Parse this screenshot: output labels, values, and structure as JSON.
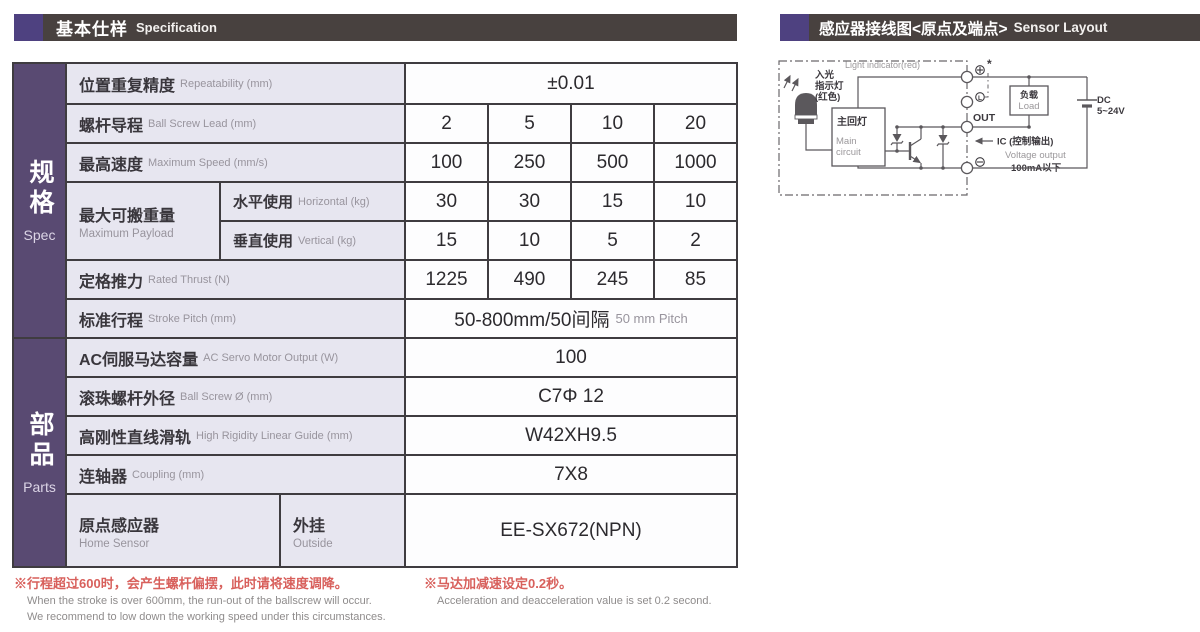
{
  "colors": {
    "header_bar_bg": "#48413f",
    "accent_purple": "#4e4180",
    "sidebar_purple": "#594a72",
    "label_cell_bg": "#e7e6f0",
    "table_border": "#3f3c40",
    "note_red": "#d8605c",
    "secondary_gray": "#98949d"
  },
  "spec": {
    "header": {
      "zh": "基本仕样",
      "en": "Specification"
    },
    "sidebar": {
      "spec_zh": "规格",
      "spec_en": "Spec",
      "parts_zh": "部品",
      "parts_en": "Parts"
    },
    "rows": [
      {
        "zh": "位置重复精度",
        "en": "Repeatability (mm)",
        "value": "±0.01"
      },
      {
        "zh": "螺杆导程",
        "en": "Ball Screw Lead (mm)",
        "v1": "2",
        "v2": "5",
        "v3": "10",
        "v4": "20"
      },
      {
        "zh": "最高速度",
        "en": "Maximum Speed (mm/s)",
        "v1": "100",
        "v2": "250",
        "v3": "500",
        "v4": "1000"
      },
      {
        "zh": "最大可搬重量",
        "en": "Maximum Payload",
        "sub1": {
          "zh": "水平使用",
          "en": "Horizontal (kg)",
          "v1": "30",
          "v2": "30",
          "v3": "15",
          "v4": "10"
        },
        "sub2": {
          "zh": "垂直使用",
          "en": "Vertical (kg)",
          "v1": "15",
          "v2": "10",
          "v3": "5",
          "v4": "2"
        }
      },
      {
        "zh": "定格推力",
        "en": "Rated Thrust (N)",
        "v1": "1225",
        "v2": "490",
        "v3": "245",
        "v4": "85"
      },
      {
        "zh": "标准行程",
        "en": "Stroke Pitch (mm)",
        "value": "50-800mm/50间隔",
        "value_en": "50 mm Pitch"
      },
      {
        "zh": "AC伺服马达容量",
        "en": "AC Servo Motor Output (W)",
        "value": "100"
      },
      {
        "zh": "滚珠螺杆外径",
        "en": "Ball Screw Ø (mm)",
        "value": "C7Φ 12"
      },
      {
        "zh": "高刚性直线滑轨",
        "en": "High Rigidity Linear Guide (mm)",
        "value": "W42XH9.5"
      },
      {
        "zh": "连轴器",
        "en": "Coupling (mm)",
        "value": "7X8"
      },
      {
        "zh": "原点感应器",
        "en": "Home Sensor",
        "sub_zh": "外挂",
        "sub_en": "Outside",
        "value": "EE-SX672(NPN)"
      }
    ],
    "notes": {
      "note1_zh": "※行程超过600时，会产生螺杆偏摆，此时请将速度调降。",
      "note1_en1": "When the stroke is over 600mm, the run-out of the ballscrew will occur.",
      "note1_en2": "We recommend to low down the working speed under this circumstances.",
      "note2_zh": "※马达加减速设定0.2秒。",
      "note2_en": "Acceleration and deacceleration value is set 0.2 second."
    }
  },
  "sensor": {
    "header": {
      "zh": "感应器接线图<原点及端点>",
      "en": "Sensor Layout"
    },
    "diagram": {
      "light_indicator": "Light indicator(red)",
      "led_zh1": "入光",
      "led_zh2": "指示灯",
      "led_zh3": "(红色)",
      "main_circuit_zh": "主回灯",
      "main_circuit_en1": "Main",
      "main_circuit_en2": "circuit",
      "terminal_plus_note": "*",
      "terminal_l": "L",
      "terminal_out": "OUT",
      "ic_label": "IC (控制输出)",
      "voltage_output": "Voltage output",
      "current_limit": "100mA以下",
      "load_zh": "负载",
      "load_en": "Load",
      "dc_line1": "DC",
      "dc_line2": "5~24V"
    }
  }
}
